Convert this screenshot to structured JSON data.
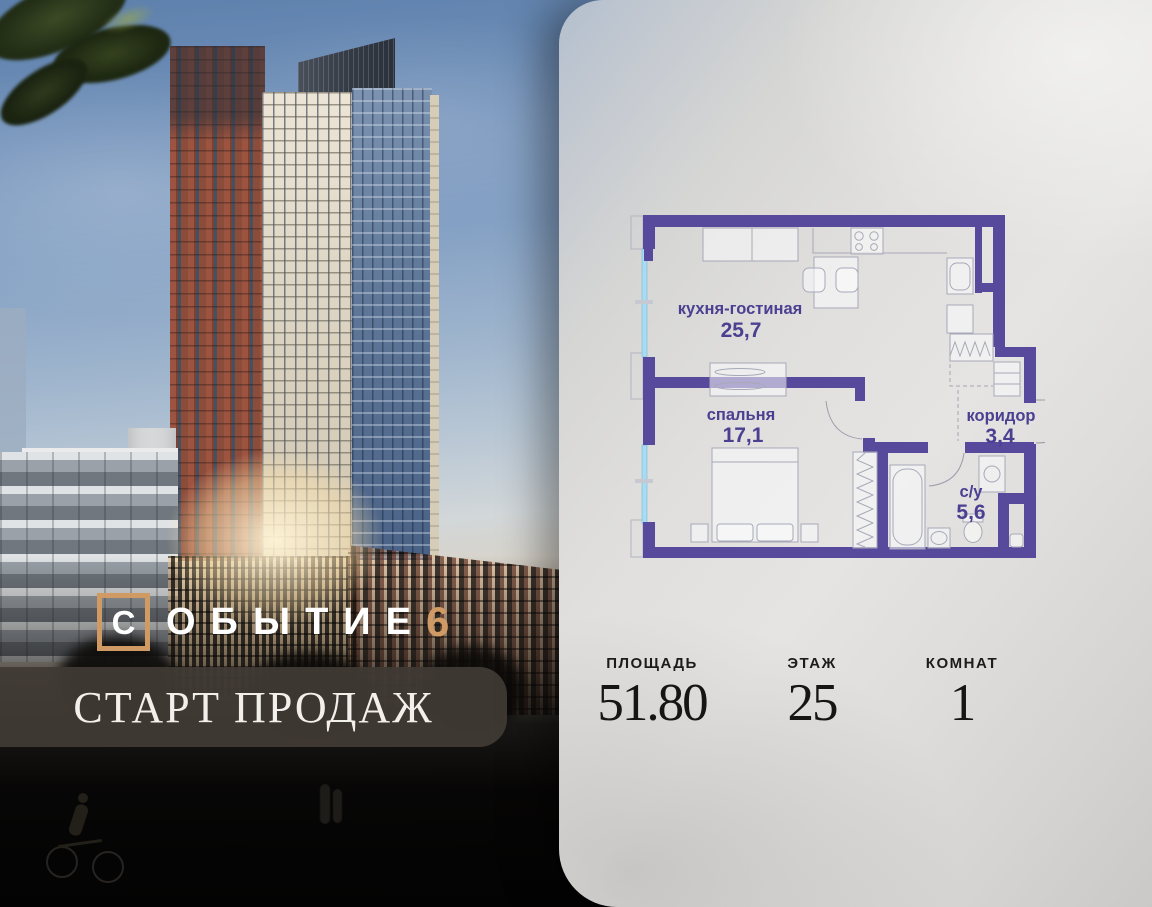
{
  "logo": {
    "brand_letter": "С",
    "brand_rest": "ОБЫТИЕ",
    "brand_number": "6",
    "accent_color": "#cf9a63"
  },
  "banner": {
    "text": "СТАРТ ПРОДАЖ"
  },
  "floor_plan": {
    "wall_color": "#57499c",
    "label_color": "#4a3f90",
    "window_color": "#a8dcf2",
    "rooms": [
      {
        "name": "кухня-гостиная",
        "area": "25,7"
      },
      {
        "name": "спальня",
        "area": "17,1"
      },
      {
        "name": "коридор",
        "area": "3,4"
      },
      {
        "name": "с/у",
        "area": "5,6"
      }
    ]
  },
  "stats": [
    {
      "label": "ПЛОЩАДЬ",
      "value": "51.80"
    },
    {
      "label": "ЭТАЖ",
      "value": "25"
    },
    {
      "label": "КОМНАТ",
      "value": "1"
    }
  ]
}
